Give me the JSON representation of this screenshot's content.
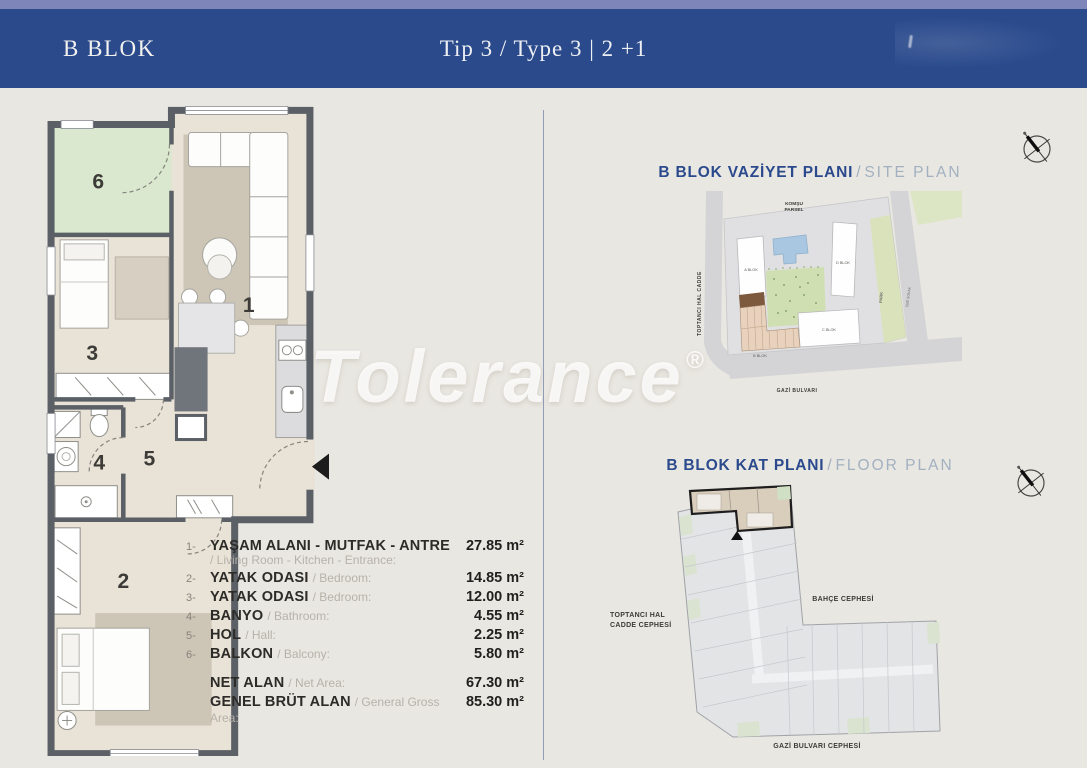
{
  "header": {
    "left": "B BLOK",
    "center": "Tip 3 / Type 3 | 2 +1"
  },
  "watermark": {
    "text": "Tolerance",
    "reg": "®"
  },
  "unit_plan": {
    "rooms": [
      "1",
      "2",
      "3",
      "4",
      "5",
      "6"
    ]
  },
  "legend": {
    "rows": [
      {
        "num": "1-",
        "tr": "YAŞAM ALANI - MUTFAK - ANTRE",
        "en": "/ Living Room - Kitchen - Entrance:",
        "value": "27.85 m²"
      },
      {
        "num": "2-",
        "tr": "YATAK ODASI",
        "en": "/ Bedroom:",
        "value": "14.85 m²"
      },
      {
        "num": "3-",
        "tr": "YATAK ODASI",
        "en": "/ Bedroom:",
        "value": "12.00 m²"
      },
      {
        "num": "4-",
        "tr": "BANYO",
        "en": "/ Bathroom:",
        "value": "4.55 m²"
      },
      {
        "num": "5-",
        "tr": "HOL",
        "en": "/ Hall:",
        "value": "2.25 m²"
      },
      {
        "num": "6-",
        "tr": "BALKON",
        "en": "/ Balcony:",
        "value": "5.80 m²"
      }
    ],
    "totals": [
      {
        "tr": "NET ALAN",
        "en": "/ Net Area:",
        "value": "67.30 m²"
      },
      {
        "tr": "GENEL BRÜT ALAN",
        "en": "/ General Gross Area:",
        "value": "85.30 m²"
      }
    ]
  },
  "site_plan": {
    "title_tr": "B BLOK VAZİYET PLANI",
    "title_sep": "/",
    "title_en": "SITE PLAN",
    "labels": {
      "komsu1": "KOMŞU",
      "komsu2": "PARSEL",
      "street_left": "TOPTANCI HAL CADDE",
      "street_bottom": "GAZİ BULVARI",
      "street_right": "EBE SOKAK",
      "park": "PARK",
      "block_a": "A BLOK",
      "block_b": "B BLOK",
      "block_c": "C BLOK",
      "block_d": "D BLOK"
    }
  },
  "key_plan": {
    "title_tr": "B BLOK KAT PLANI",
    "title_sep": "/",
    "title_en": "FLOOR PLAN",
    "facade_left1": "TOPTANCI HAL",
    "facade_left2": "CADDE CEPHESİ",
    "facade_right": "BAHÇE CEPHESİ",
    "facade_bottom": "GAZİ BULVARI CEPHESİ"
  },
  "colors": {
    "header_bg": "#2a4a8c",
    "accent_blue": "#2b4a8d",
    "title_gray": "#a2b0c1",
    "wall": "#5b6066",
    "floor": "#e9e2d6",
    "balcony_green": "#d9e8ce",
    "highlight_tan": "#e9d2bd"
  }
}
